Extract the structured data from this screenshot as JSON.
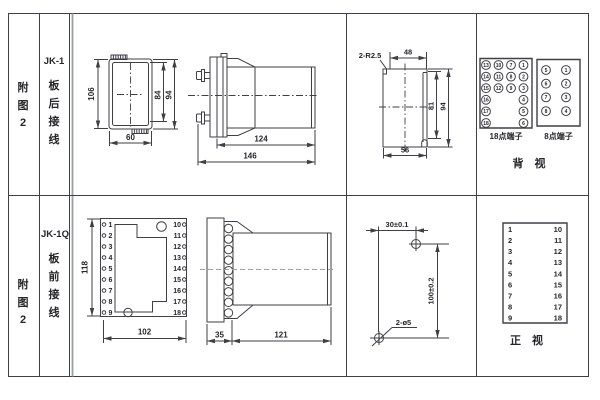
{
  "colors": {
    "line": "#3f3f46",
    "text": "#26262b",
    "gray_line": "#9aa0a6",
    "bg": "#ffffff"
  },
  "row_top": {
    "figure_no": [
      "附",
      "图",
      "2"
    ],
    "model": "JK-1",
    "wiring": [
      "板",
      "后",
      "接",
      "线"
    ],
    "front_view": {
      "height": "106",
      "width": "60",
      "inner_height": "84",
      "outer_height": "94"
    },
    "side_view": {
      "body_depth": "124",
      "total_depth": "146"
    },
    "cutout": {
      "corner_radius": "2-R2.5",
      "top_width": "48",
      "inner_height": "81",
      "outer_height": "94",
      "bottom_width": "56"
    },
    "terminals18": {
      "caption": "18点端子",
      "grid": [
        [
          13,
          10,
          7,
          1
        ],
        [
          14,
          11,
          8,
          2
        ],
        [
          15,
          12,
          9,
          3
        ],
        [
          16,
          null,
          null,
          4
        ],
        [
          17,
          null,
          null,
          5
        ],
        [
          18,
          null,
          null,
          6
        ]
      ]
    },
    "terminals8": {
      "caption": "8点端子",
      "grid": [
        [
          5,
          1
        ],
        [
          6,
          2
        ],
        [
          7,
          3
        ],
        [
          8,
          4
        ]
      ]
    },
    "view_label": "背　视"
  },
  "row_bottom": {
    "figure_no": [
      "附",
      "图",
      "2"
    ],
    "model": "JK-1Q",
    "wiring": [
      "板",
      "前",
      "接",
      "线"
    ],
    "front_view": {
      "height": "118",
      "width": "102",
      "left_terminals": [
        "1",
        "2",
        "3",
        "4",
        "5",
        "6",
        "7",
        "8",
        "9"
      ],
      "right_terminals": [
        "10",
        "11",
        "12",
        "13",
        "14",
        "15",
        "16",
        "17",
        "18"
      ]
    },
    "side_view": {
      "flange_depth": "35",
      "body_depth": "121"
    },
    "drilling": {
      "hole_spacing_h": "30±0.1",
      "hole_spacing_v": "100±0.2",
      "hole_spec": "2-ø5"
    },
    "terminal_list": {
      "left": [
        "1",
        "2",
        "3",
        "4",
        "5",
        "6",
        "7",
        "8",
        "9"
      ],
      "right": [
        "10",
        "11",
        "12",
        "13",
        "14",
        "15",
        "16",
        "17",
        "18"
      ]
    },
    "view_label": "正　视"
  }
}
